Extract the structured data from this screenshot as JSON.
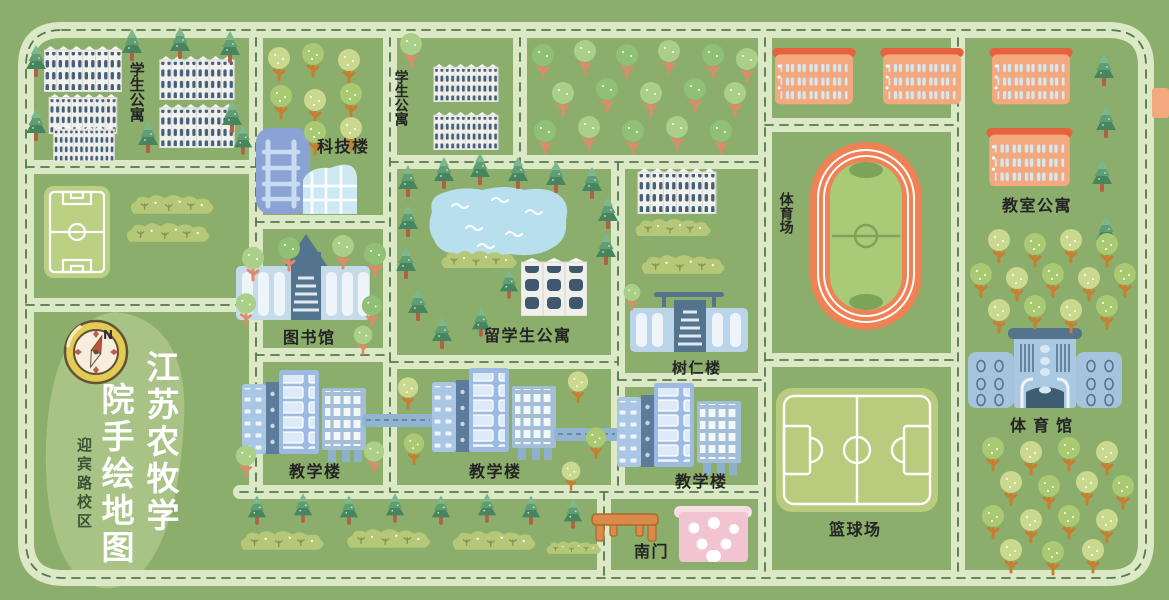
{
  "title": {
    "col1": "江苏农牧学",
    "col2": "院手绘地图",
    "subtitle": "迎宾路校区"
  },
  "compass": {
    "north": "N"
  },
  "places": {
    "student_apartments_nw": {
      "label": "学生公寓"
    },
    "student_apartments_n": {
      "label": "学生公寓"
    },
    "science_building": {
      "label": "科技楼"
    },
    "library": {
      "label": "图书馆"
    },
    "intl_student_apartments": {
      "label": "留学生公寓"
    },
    "shuren_building": {
      "label": "树仁楼"
    },
    "teaching_building_west": {
      "label": "教学楼"
    },
    "teaching_building_center": {
      "label": "教学楼"
    },
    "teaching_building_east": {
      "label": "教学楼"
    },
    "stadium": {
      "label": "体育场"
    },
    "classroom_apartments": {
      "label": "教室公寓"
    },
    "gymnasium": {
      "label": "体育馆"
    },
    "basketball_court": {
      "label": "篮球场"
    },
    "south_gate": {
      "label": "南门"
    }
  },
  "colors": {
    "background": "#8cae6c",
    "road": "#dce9c7",
    "road_dash": "#57774e",
    "track_orange": "#ef8155",
    "building_orange": "#f4a87e",
    "building_blue": "#9dbae1",
    "lake_blue": "#b7dfee",
    "pink_building": "#f2c3d0",
    "title_text": "#ffffff"
  }
}
